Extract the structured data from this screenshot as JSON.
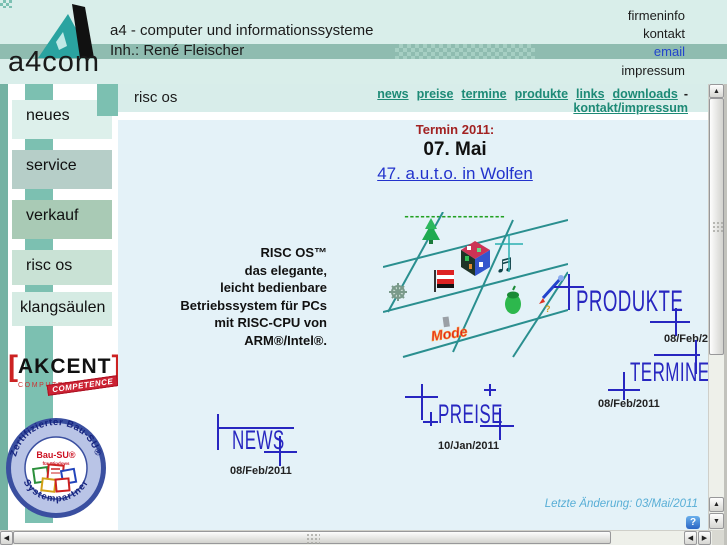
{
  "window": {
    "width": 727,
    "height": 545
  },
  "colors": {
    "header_bg": "#d9eeea",
    "band": "#8fbcb0",
    "connector": "#7cc0b1",
    "content_bg": "#e4f2f8",
    "nav_link": "#1d8a76",
    "stamp_blue": "#2726c0",
    "termin_red": "#a22222",
    "link_blue": "#2233cc",
    "dash_green": "#22a022",
    "footer_blue": "#58aed6",
    "akcent_red": "#cc2222",
    "badge_blue": "#3a4fa0"
  },
  "header": {
    "logo_text": "a4com",
    "title_line1": "a4 - computer und informationssysteme",
    "title_line2": "Inh.: René Fleischer",
    "links": [
      {
        "label": "firmeninfo"
      },
      {
        "label": "kontakt"
      },
      {
        "label": "email"
      },
      {
        "label": "impressum"
      }
    ]
  },
  "sidebar": {
    "items": [
      {
        "label": "neues"
      },
      {
        "label": "service"
      },
      {
        "label": "verkauf"
      },
      {
        "label": "risc os"
      },
      {
        "label": "klangsäulen"
      }
    ],
    "akcent": {
      "bracket_open": "[",
      "name": "AKCENT",
      "bracket_close": "]",
      "registered": "®",
      "subtitle": "COMPUTERPARTNER",
      "stamp": "COMPETENCE"
    },
    "bausu": {
      "ring_top": "Zertifizierter Bau-SU®",
      "ring_bottom": "Systempartner",
      "center_name": "Bau-SU®",
      "center_sub": "für Windows"
    }
  },
  "content": {
    "page_title": "risc os",
    "nav": {
      "items": [
        "news",
        "preise",
        "termine",
        "produkte",
        "links",
        "downloads"
      ],
      "separator": "-",
      "line2": "kontakt/impressum"
    },
    "termin": {
      "heading": "Termin 2011:",
      "date": "07. Mai",
      "link": "47. a.u.t.o. in Wolfen",
      "divider": "-------------------"
    },
    "intro": {
      "lines": [
        "RISC OS™",
        "das elegante,",
        "leicht bedienbare",
        "Betriebssystem für PCs",
        "mit RISC-CPU von",
        "ARM®/Intel®."
      ]
    },
    "artwork_caption": "Mode",
    "stamps": [
      {
        "label": "PRODUKTE",
        "date": "08/Feb/2011"
      },
      {
        "label": "TERMINE",
        "date": "08/Feb/2011"
      },
      {
        "label": "PREISE",
        "date": "10/Jan/2011"
      },
      {
        "label": "NEWS",
        "date": "08/Feb/2011"
      }
    ],
    "footer_note": "Letzte Änderung: 03/Mai/2011",
    "help_icon": "?"
  },
  "scrollbar": {
    "up": "▲",
    "down": "▼",
    "left": "◀",
    "right": "▶"
  }
}
